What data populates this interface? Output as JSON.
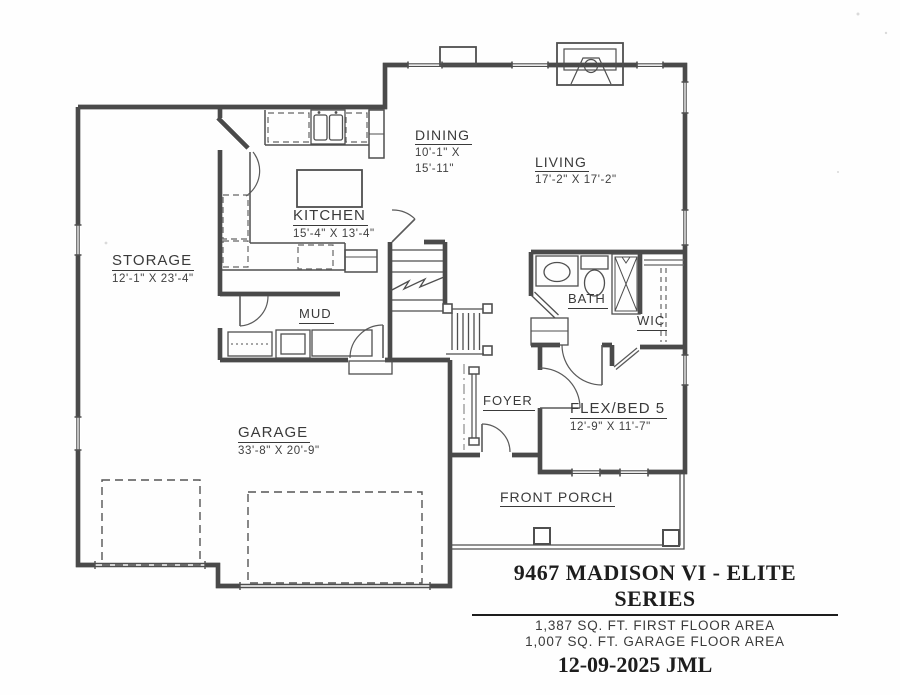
{
  "drawing": {
    "line_color": "#4a4a4a",
    "text_color": "#3a3a3a",
    "paper_color": "#fefefe"
  },
  "labels": {
    "storage": {
      "name": "STORAGE",
      "dims": "12'-1\" X 23'-4\""
    },
    "kitchen": {
      "name": "KITCHEN",
      "dims": "15'-4\" X 13'-4\""
    },
    "dining": {
      "name": "DINING",
      "dims1": "10'-1\" X",
      "dims2": "15'-11\""
    },
    "living": {
      "name": "LIVING",
      "dims": "17'-2\" X 17'-2\""
    },
    "mud": {
      "name": "MUD"
    },
    "bath": {
      "name": "BATH"
    },
    "wic": {
      "name": "WIC"
    },
    "foyer": {
      "name": "FOYER"
    },
    "flex": {
      "name": "FLEX/BED 5",
      "dims": "12'-9\" X 11'-7\""
    },
    "garage": {
      "name": "GARAGE",
      "dims": "33'-8\" X 20'-9\""
    },
    "porch": {
      "name": "FRONT PORCH"
    }
  },
  "title_block": {
    "title": "9467 MADISON VI - ELITE  SERIES",
    "area1": "1,387 SQ. FT. FIRST FLOOR AREA",
    "area2": "1,007 SQ. FT. GARAGE FLOOR AREA",
    "date": "12-09-2025 JML"
  }
}
